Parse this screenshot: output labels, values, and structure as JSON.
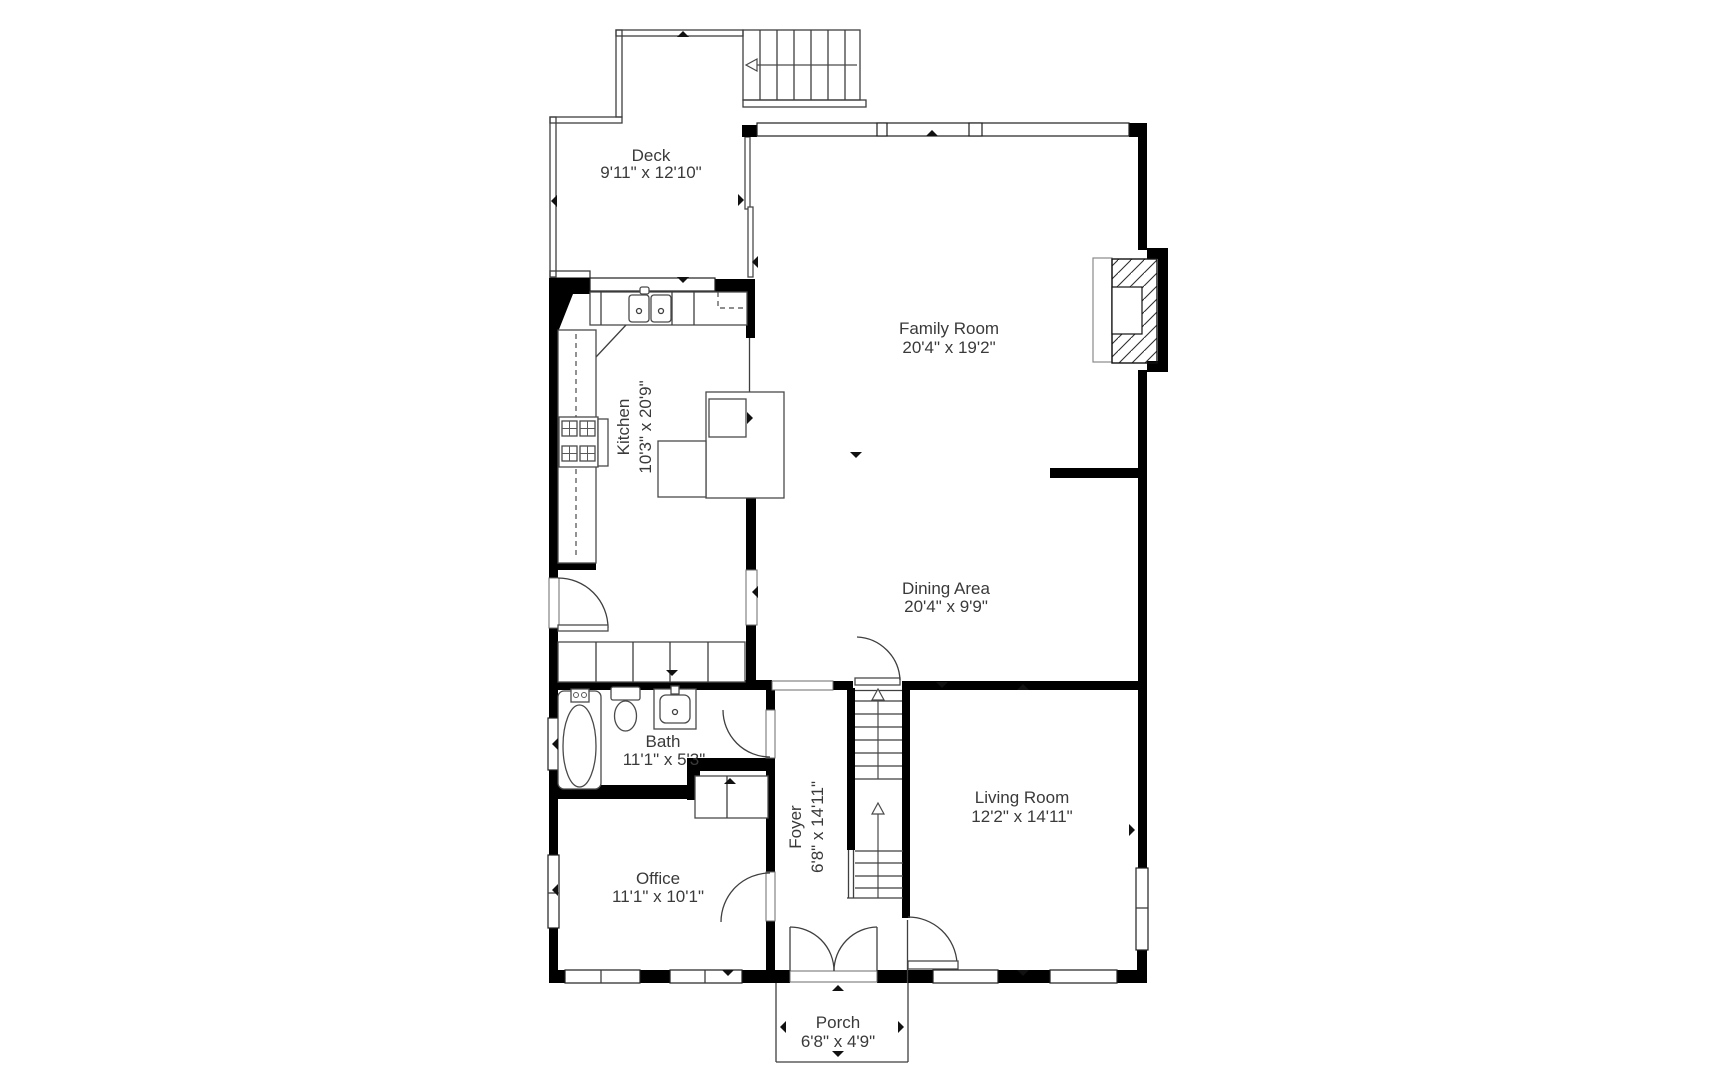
{
  "plan": {
    "background": "#ffffff",
    "wall_color": "#000000",
    "line_color": "#3f3f3f",
    "text_color": "#3a3a3a"
  },
  "rooms": {
    "deck": {
      "name": "Deck",
      "dims": "9'11\" x 12'10\""
    },
    "family_room": {
      "name": "Family Room",
      "dims": "20'4\" x 19'2\""
    },
    "kitchen": {
      "name": "Kitchen",
      "dims": "10'3\" x 20'9\""
    },
    "dining_area": {
      "name": "Dining Area",
      "dims": "20'4\" x 9'9\""
    },
    "bath": {
      "name": "Bath",
      "dims": "11'1\" x 5'3\""
    },
    "foyer": {
      "name": "Foyer",
      "dims": "6'8\" x 14'11\""
    },
    "living_room": {
      "name": "Living Room",
      "dims": "12'2\" x 14'11\""
    },
    "office": {
      "name": "Office",
      "dims": "11'1\" x 10'1\""
    },
    "porch": {
      "name": "Porch",
      "dims": "6'8\" x 4'9\""
    }
  }
}
